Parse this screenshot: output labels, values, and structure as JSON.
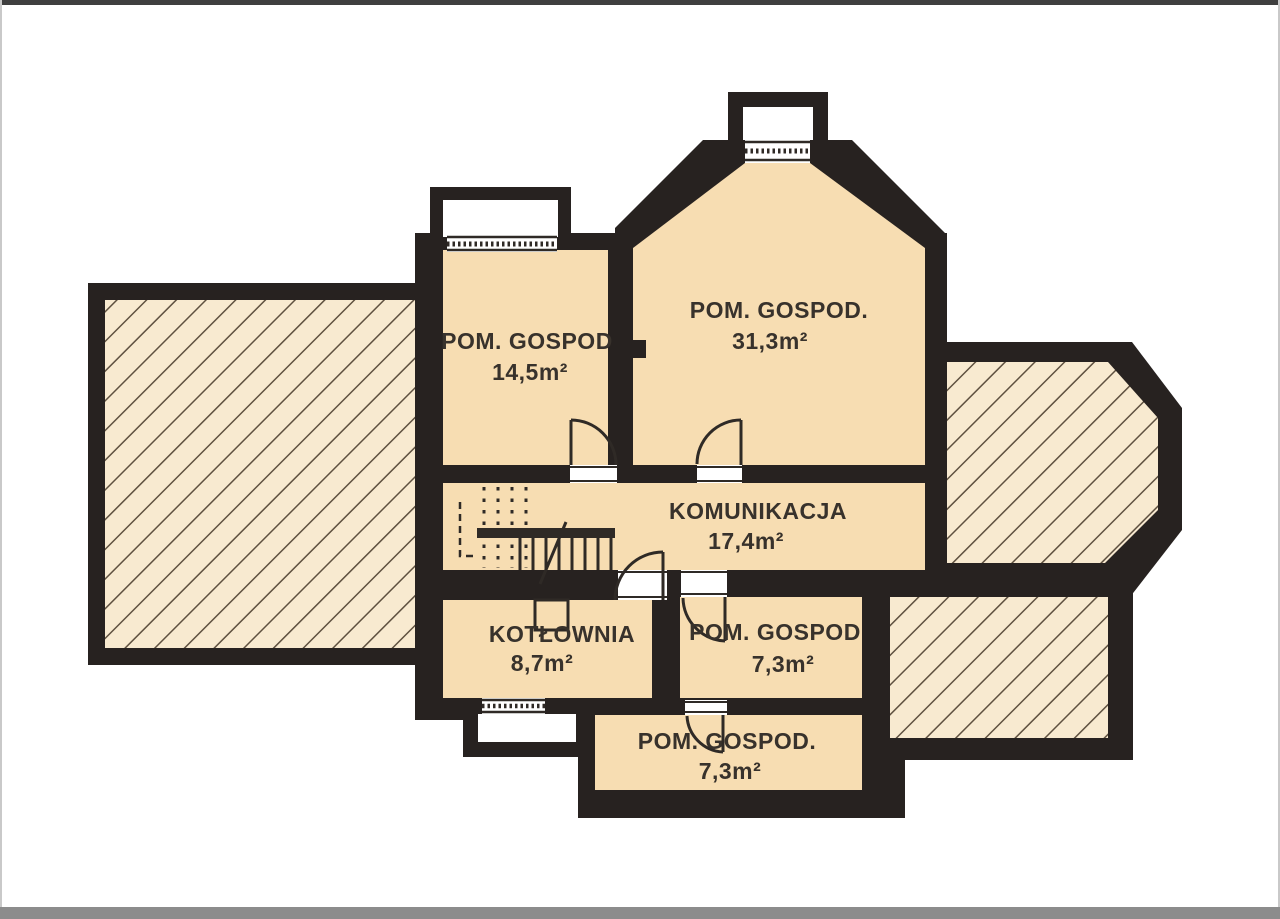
{
  "title": "Basement floor plan",
  "colors": {
    "wall": "#272220",
    "room_fill": "#f7ddb2",
    "hatch_fill": "#f8ead0",
    "hatch_line": "#5f5140",
    "symbol": "#2f2a26",
    "text": "#38322c",
    "white": "#ffffff",
    "frame_top": "#3f3f3f",
    "frame_bottom": "#8c8c8c"
  },
  "rooms": [
    {
      "id": "pom-gospod-nw",
      "label": "POM. GOSPOD",
      "area": "14,5m²"
    },
    {
      "id": "pom-gospod-big",
      "label": "POM. GOSPOD.",
      "area": "31,3m²"
    },
    {
      "id": "komunikacja",
      "label": "KOMUNIKACJA",
      "area": "17,4m²"
    },
    {
      "id": "kotlownia",
      "label": "KOTŁOWNIA",
      "area": "8,7m²"
    },
    {
      "id": "pom-gospod-east",
      "label": "POM. GOSPOD",
      "area": "7,3m²"
    },
    {
      "id": "pom-gospod-south",
      "label": "POM. GOSPOD.",
      "area": "7,3m²"
    }
  ]
}
